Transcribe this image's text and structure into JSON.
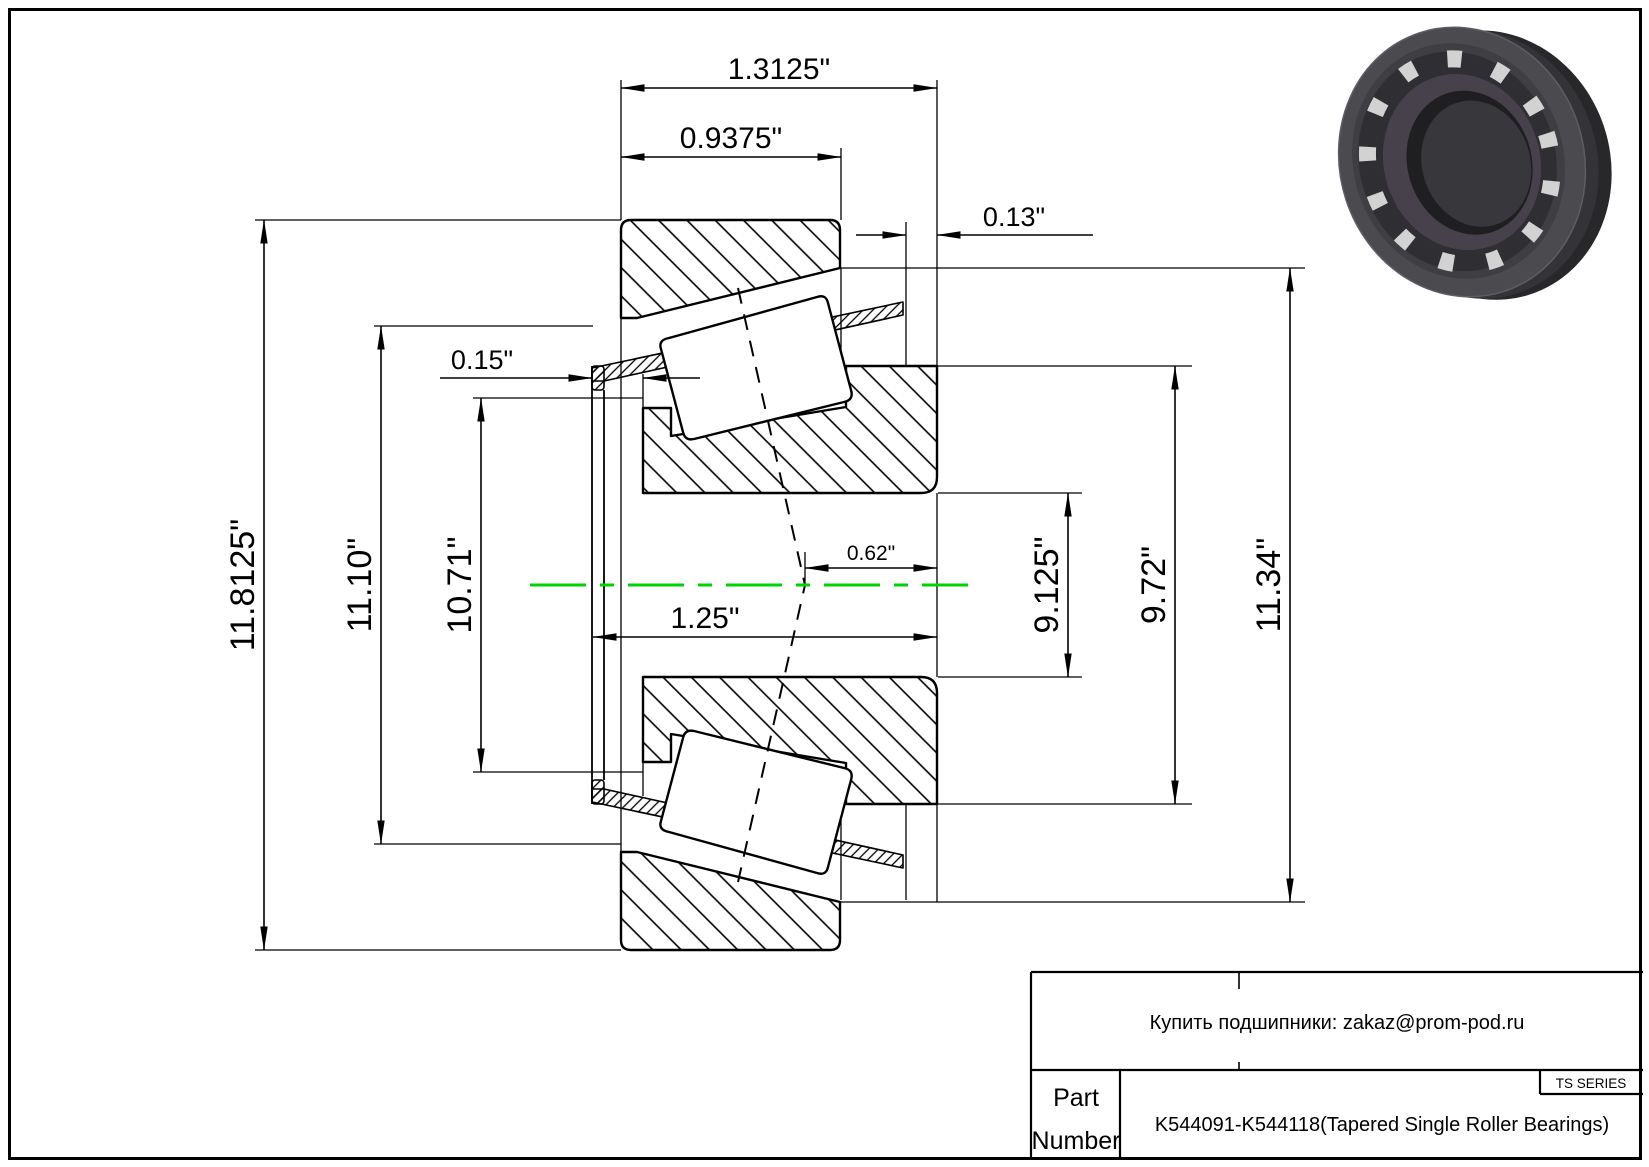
{
  "drawing": {
    "type": "tapered-roller-bearing-cross-section",
    "centerline_color": "#00d400",
    "line_color": "#000000",
    "dimensions": {
      "overall_width": "1.3125\"",
      "cup_width": "0.9375\"",
      "back_offset": "0.13\"",
      "front_offset": "0.15\"",
      "inner_width": "1.25\"",
      "center_offset": "0.62\"",
      "outer_diameter": "11.8125\"",
      "cage_front_diameter": "11.10\"",
      "rib_front_diameter": "10.71\"",
      "bore_spacing": "9.125\"",
      "rib_back_diameter": "9.72\"",
      "back_diameter": "11.34\""
    }
  },
  "title_block": {
    "contact": "Купить подшипники: zakaz@prom-pod.ru",
    "series": "TS SERIES",
    "part_label_line1": "Part",
    "part_label_line2": "Number",
    "part_number": "K544091-K544118(Tapered Single Roller Bearings)"
  },
  "product_image": {
    "description": "tapered-roller-bearing-3d-render",
    "body_color": "#4a4a4f",
    "roller_color": "#d2d2d3",
    "bore_color": "#1f1f22"
  }
}
